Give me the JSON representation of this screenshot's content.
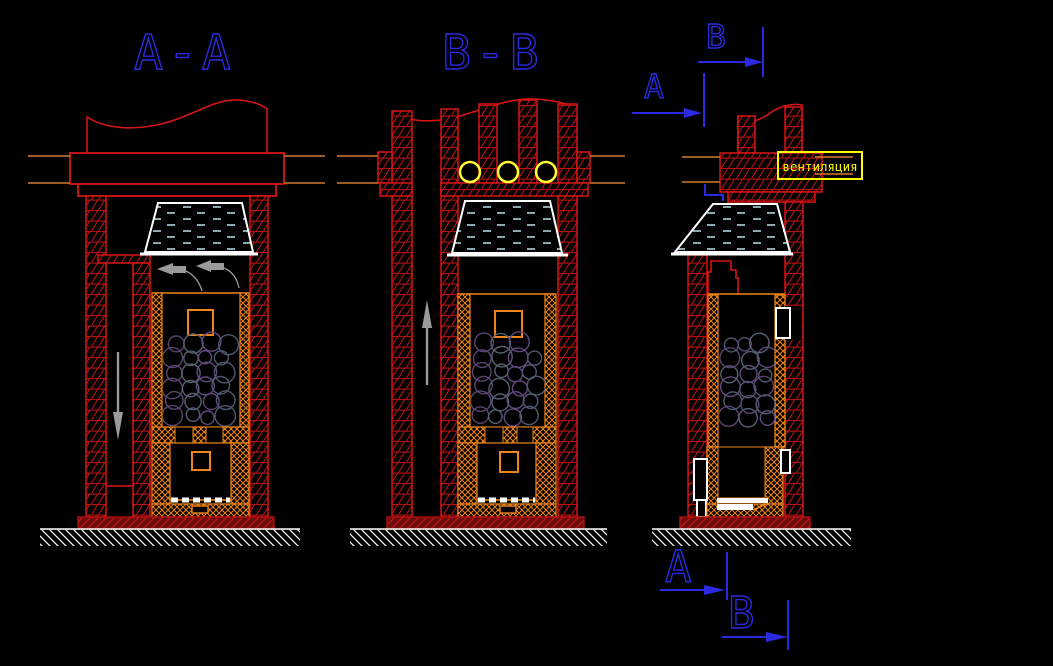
{
  "drawing": {
    "type": "CAD section drawing of masonry stove",
    "background": "#000000"
  },
  "views": {
    "section_aa": {
      "label": "A-A"
    },
    "section_bb": {
      "label": "B-B"
    },
    "side_view": {
      "vent_label": "вентиляция"
    }
  },
  "cut_marks": {
    "top_b": "B",
    "top_a": "A",
    "bottom_a": "A",
    "bottom_b": "B"
  },
  "colors": {
    "background": "#000000",
    "wall_red": "#d81414",
    "brick_hatch_red": "#c81212",
    "plinth_red": "#6e0d0d",
    "lining_orange": "#f08418",
    "duct_orange": "#cf7a2e",
    "label_blue": "#2a2ae0",
    "vent_yellow": "#ffff00",
    "vent_hole_yellow": "#ffff33",
    "water_cyan": "#b9dfe8",
    "arrow_gray": "#9a9a9a",
    "stone_purple": "#5a4472",
    "stone_gray": "#556070",
    "white": "#ffffff"
  }
}
